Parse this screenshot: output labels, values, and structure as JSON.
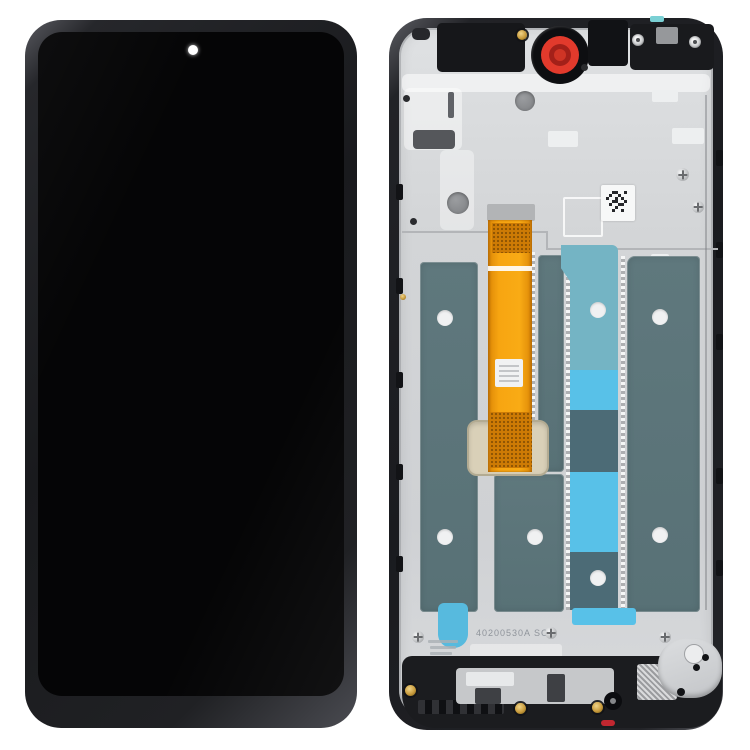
{
  "photo": {
    "type": "phone-lcd-assembly-product-photo",
    "views": {
      "left": "front-lcd",
      "right": "back-frame"
    },
    "back_view": {
      "serial_text": "40200530A SC"
    },
    "colors": {
      "background": "#ffffff",
      "front_frame": "#202124",
      "front_screen": "#050506",
      "camera_dot": "#ffffff",
      "back_frame": "#1d1e22",
      "back_plate": "#d4d6d8",
      "flex_cable_orange": "#f7a511",
      "flex_cable_dark": "#cd7b05",
      "adhesive_panel_teal": "#5e777c",
      "adhesive_cyan_bright": "#58c1e8",
      "adhesive_cyan_muted": "#74b4c4",
      "camera_gasket_red": "#e23a2c",
      "gold_screw": "#c89b3c",
      "connector_pad_tan": "#d9d0b8"
    }
  }
}
